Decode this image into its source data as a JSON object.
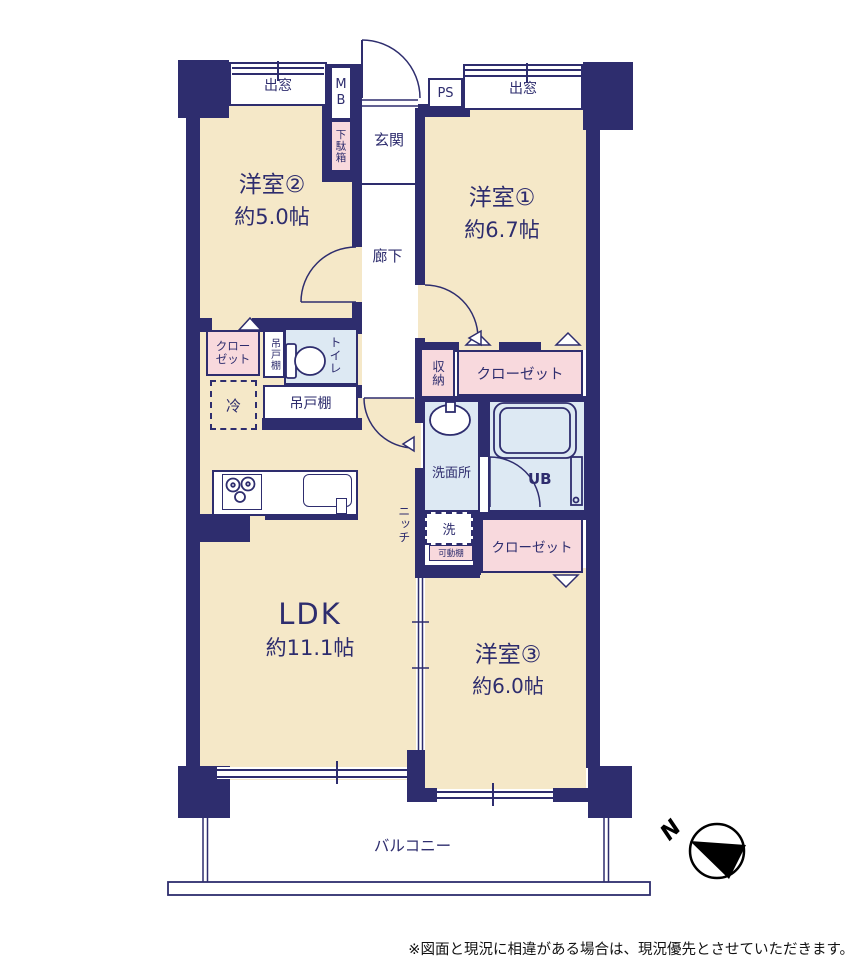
{
  "colors": {
    "wall": "#2e2d6e",
    "room_fill": "#f5e8c8",
    "closet_fill": "#f8d9dd",
    "wet_area_fill": "#dde9f3",
    "north_arrow": "#000000"
  },
  "rooms": {
    "western2": {
      "label": "洋室②",
      "size": "約5.0帖"
    },
    "western1": {
      "label": "洋室①",
      "size": "約6.7帖"
    },
    "western3": {
      "label": "洋室③",
      "size": "約6.0帖"
    },
    "ldk": {
      "label": "LDK",
      "size": "約11.1帖"
    },
    "entrance": "玄関",
    "hallway": "廊下",
    "washroom": "洗面所",
    "unit_bath": "UB",
    "toilet": "トイレ",
    "balcony": "バルコニー"
  },
  "features": {
    "bay_window_left": "出窓",
    "bay_window_right": "出窓",
    "meter_box": "MB",
    "pipe_space": "PS",
    "shoe_cabinet": "下駄箱",
    "closet_left": "クローゼット",
    "closet_upper_right": "クローゼット",
    "closet_lower_right": "クローゼット",
    "storage": "収納",
    "hanging_cupboard_side": "吊戸棚",
    "hanging_cupboard_kitchen": "吊戸棚",
    "refrigerator": "冷",
    "washer": "洗",
    "movable_shelf": "可動棚",
    "niche": "ニッチ"
  },
  "compass": {
    "north_label": "N"
  },
  "footer": {
    "disclaimer": "※図面と現況に相違がある場合は、現況優先とさせていただきます。"
  }
}
